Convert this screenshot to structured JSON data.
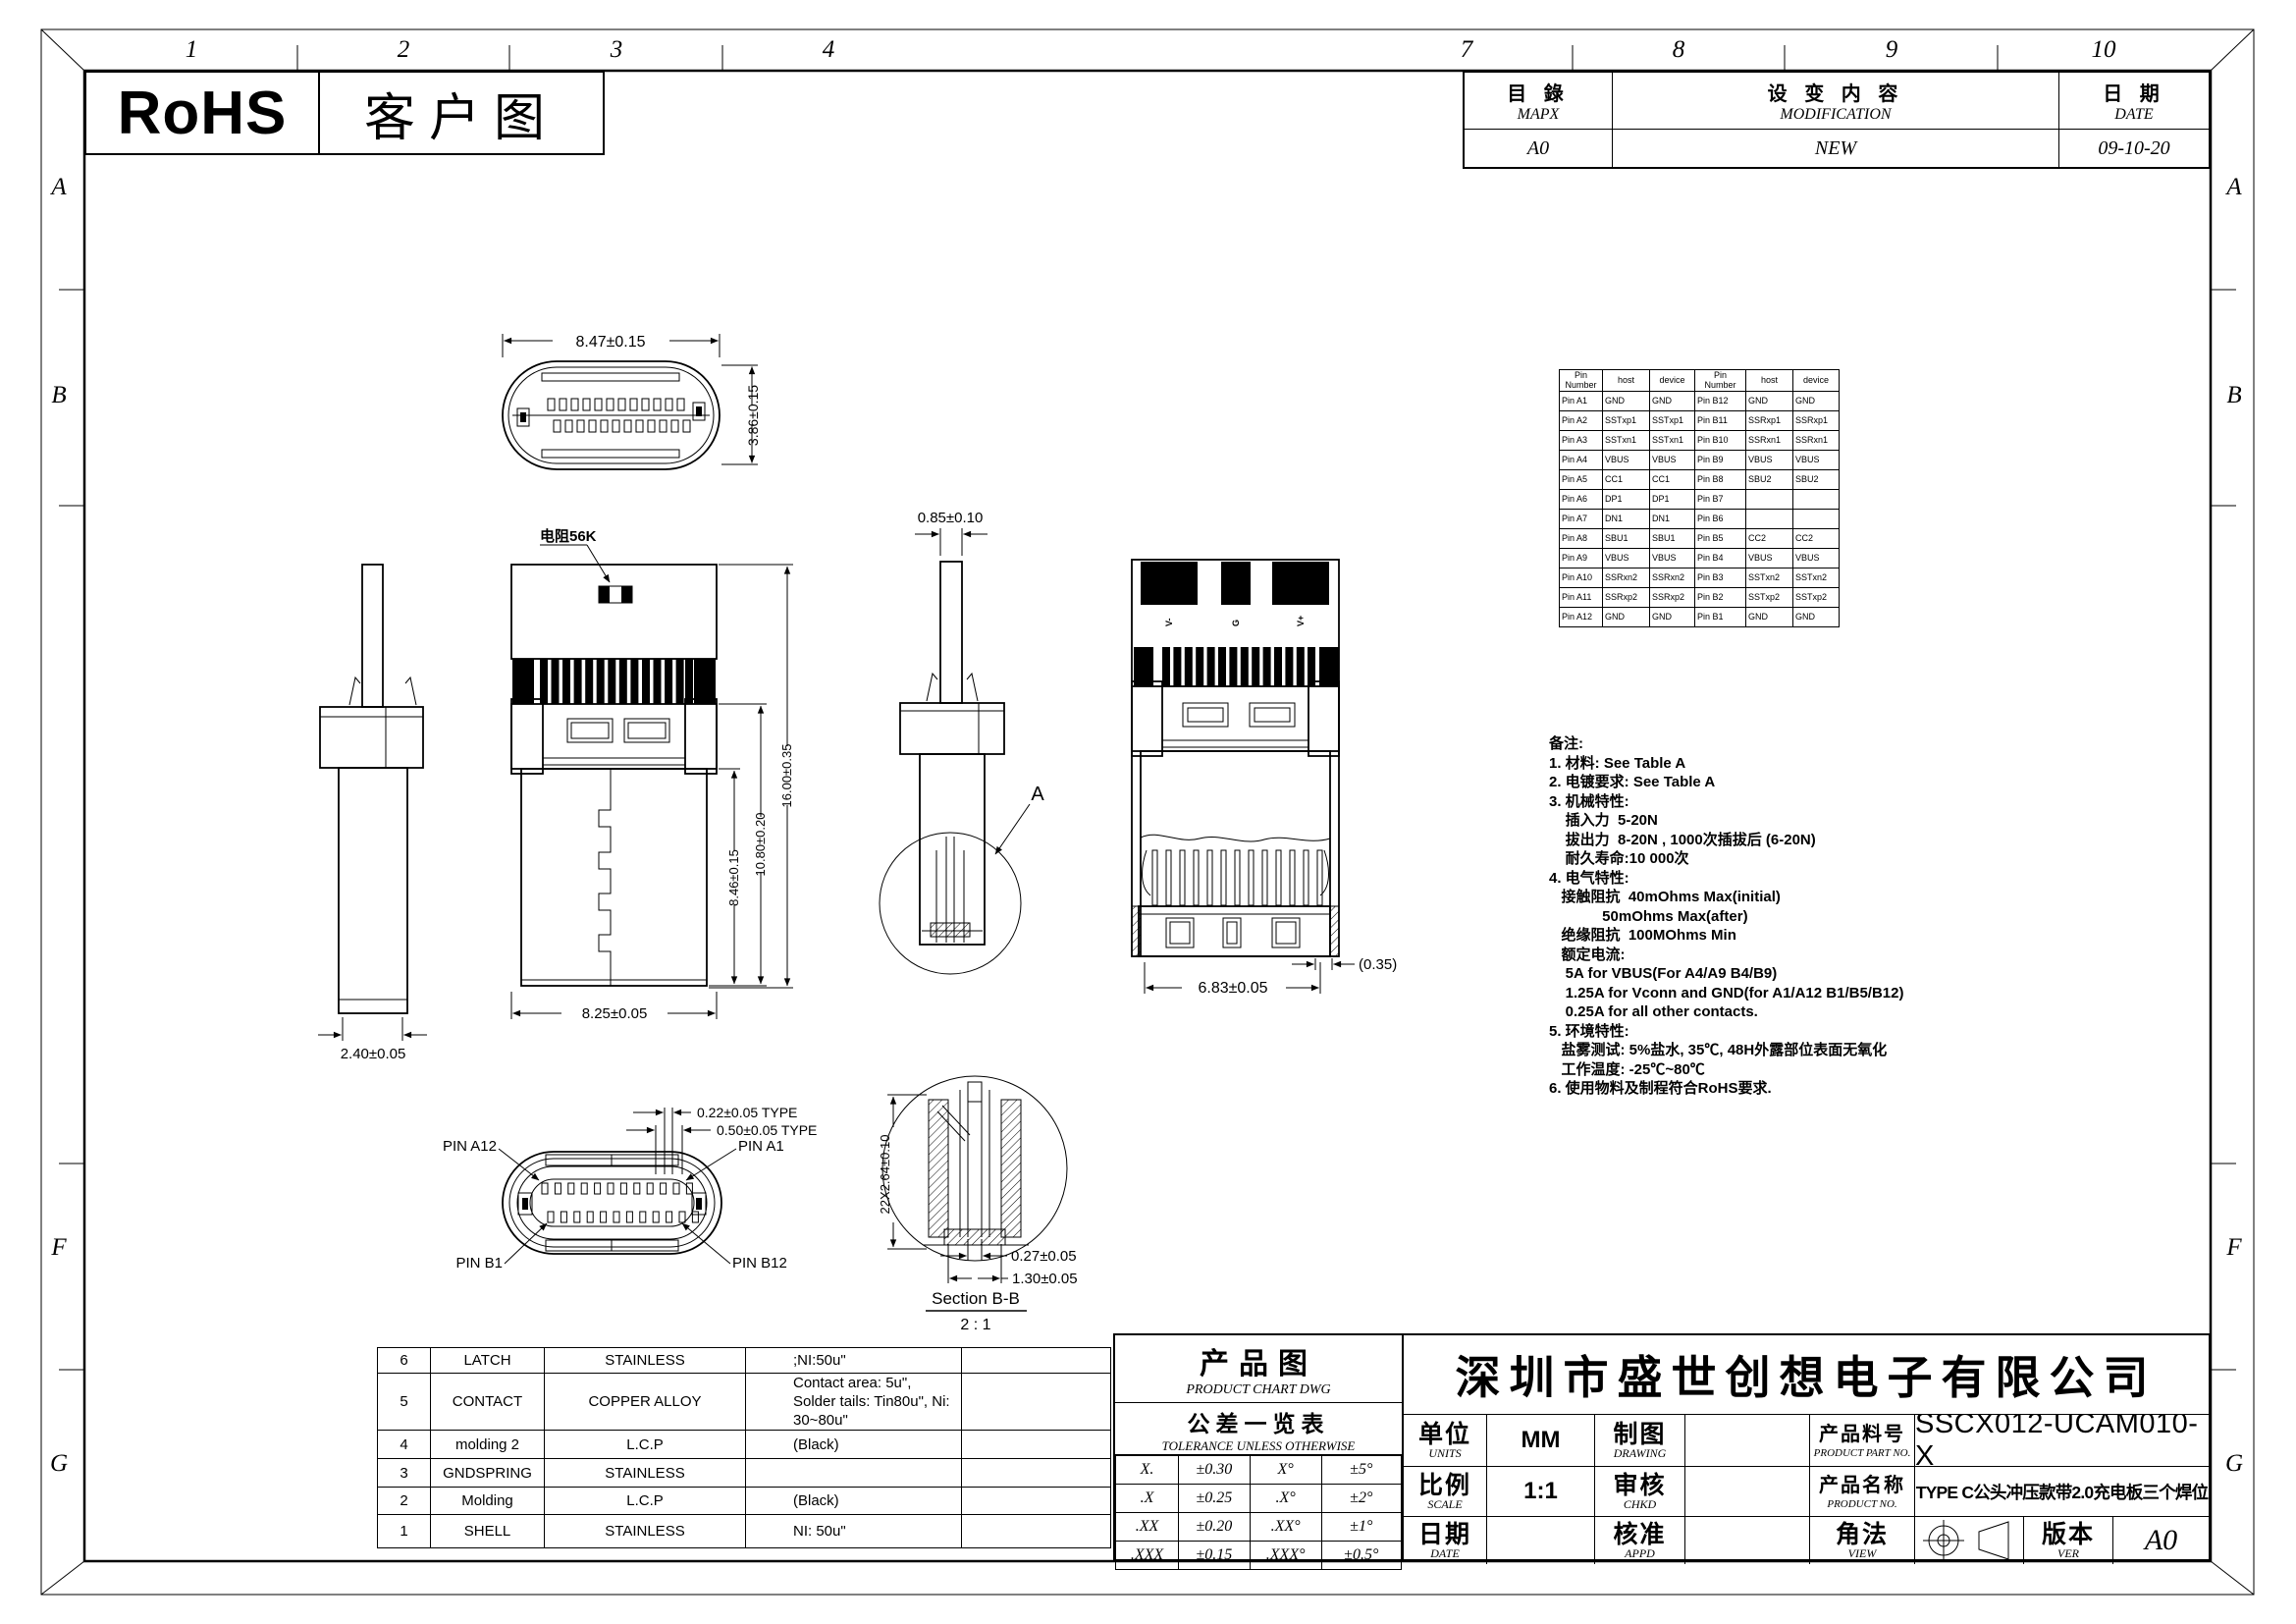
{
  "sheet": {
    "zone_numbers_top": [
      "1",
      "2",
      "3",
      "4",
      "7",
      "8",
      "9",
      "10"
    ],
    "zone_letters": [
      "A",
      "B",
      "F",
      "G"
    ]
  },
  "header": {
    "rohs": "RoHS",
    "customer_drawing": "客户图"
  },
  "revision_table": {
    "col1_cn": "目 錄",
    "col1_en": "MAPX",
    "col2_cn": "设 变 内 容",
    "col2_en": "MODIFICATION",
    "col3_cn": "日 期",
    "col3_en": "DATE",
    "row": {
      "mapx": "A0",
      "modification": "NEW",
      "date": "09-10-20"
    }
  },
  "pin_table": {
    "headers": [
      "Pin Number",
      "host",
      "device",
      "Pin Number",
      "host",
      "device"
    ],
    "rows": [
      [
        "Pin A1",
        "GND",
        "GND",
        "Pin B12",
        "GND",
        "GND"
      ],
      [
        "Pin A2",
        "SSTxp1",
        "SSTxp1",
        "Pin B11",
        "SSRxp1",
        "SSRxp1"
      ],
      [
        "Pin A3",
        "SSTxn1",
        "SSTxn1",
        "Pin B10",
        "SSRxn1",
        "SSRxn1"
      ],
      [
        "Pin A4",
        "VBUS",
        "VBUS",
        "Pin B9",
        "VBUS",
        "VBUS"
      ],
      [
        "Pin A5",
        "CC1",
        "CC1",
        "Pin B8",
        "SBU2",
        "SBU2"
      ],
      [
        "Pin A6",
        "DP1",
        "DP1",
        "Pin B7",
        "",
        ""
      ],
      [
        "Pin A7",
        "DN1",
        "DN1",
        "Pin B6",
        "",
        ""
      ],
      [
        "Pin A8",
        "SBU1",
        "SBU1",
        "Pin B5",
        "CC2",
        "CC2"
      ],
      [
        "Pin A9",
        "VBUS",
        "VBUS",
        "Pin B4",
        "VBUS",
        "VBUS"
      ],
      [
        "Pin A10",
        "SSRxn2",
        "SSRxn2",
        "Pin B3",
        "SSTxn2",
        "SSTxn2"
      ],
      [
        "Pin A11",
        "SSRxp2",
        "SSRxp2",
        "Pin B2",
        "SSTxp2",
        "SSTxp2"
      ],
      [
        "Pin A12",
        "GND",
        "GND",
        "Pin B1",
        "GND",
        "GND"
      ]
    ]
  },
  "notes": {
    "lines": [
      "备注:",
      "1. 材料: See Table A",
      "2. 电镀要求: See Table A",
      "3. 机械特性:",
      "    插入力  5-20N",
      "    拔出力  8-20N , 1000次插拔后 (6-20N)",
      "    耐久寿命:10 000次",
      "4. 电气特性:",
      "   接触阻抗  40mOhms Max(initial)",
      "             50mOhms Max(after)",
      "   绝缘阻抗  100MOhms Min",
      "   额定电流:",
      "    5A for VBUS(For A4/A9 B4/B9)",
      "    1.25A for Vconn and GND(for A1/A12 B1/B5/B12)",
      "    0.25A for all other contacts.",
      "5. 环境特性:",
      "   盐雾测试: 5%盐水, 35℃, 48H外露部位表面无氧化",
      "   工作温度: -25℃~80℃",
      "6. 使用物料及制程符合RoHS要求."
    ]
  },
  "views": {
    "top": {
      "w": "8.47±0.15",
      "h": "3.86±0.15"
    },
    "side1": {
      "w": "2.40±0.05"
    },
    "front": {
      "res": "电阻56K",
      "h1": "8.46±0.15",
      "h2": "10.80±0.20",
      "h3": "16.00±0.35",
      "w": "8.25±0.05"
    },
    "side2": {
      "tail": "0.85±0.10",
      "detail": "A"
    },
    "back": {
      "w": "6.83±0.05",
      "inset": "(0.35)",
      "pads": [
        "V-",
        "G",
        "V+"
      ]
    },
    "face": {
      "p1": "PIN A12",
      "p2": "PIN A1",
      "p3": "PIN B1",
      "p4": "PIN B12",
      "d1": "0.22±0.05 TYPE",
      "d2": "0.50±0.05 TYPE"
    },
    "section": {
      "v": "22X2.64±0.10",
      "d1": "0.27±0.05",
      "d2": "1.30±0.05",
      "title": "Section B-B",
      "scale": "2 : 1"
    }
  },
  "bom_table": {
    "rows": [
      [
        "6",
        "LATCH",
        "STAINLESS",
        ";NI:50u\"",
        ""
      ],
      [
        "5",
        "CONTACT",
        "COPPER ALLOY",
        "Contact area: 5u\",\nSolder tails: Tin80u\",  Ni: 30~80u\"",
        ""
      ],
      [
        "4",
        "molding 2",
        "L.C.P",
        "(Black)",
        ""
      ],
      [
        "3",
        "GNDSPRING",
        "STAINLESS",
        "",
        ""
      ],
      [
        "2",
        "Molding",
        "L.C.P",
        "(Black)",
        ""
      ],
      [
        "1",
        "SHELL",
        "STAINLESS",
        "NI: 50u\"",
        ""
      ]
    ]
  },
  "product_chart": {
    "title_cn": "产品图",
    "title_en": "PRODUCT CHART DWG",
    "tol_cn": "公差一览表",
    "tol_en": "TOLERANCE UNLESS OTHERWISE",
    "rows": [
      [
        "X.",
        "±0.30",
        "X°",
        "±5°"
      ],
      [
        ".X",
        "±0.25",
        ".X°",
        "±2°"
      ],
      [
        ".XX",
        "±0.20",
        ".XX°",
        "±1°"
      ],
      [
        ".XXX",
        "±0.15",
        ".XXX°",
        "±0.5°"
      ]
    ]
  },
  "title_block": {
    "company": "深圳市盛世创想电子有限公司",
    "units_cn": "单位",
    "units_en": "UNITS",
    "units_value": "MM",
    "drawing_cn": "制图",
    "drawing_en": "DRAWING",
    "part_no_cn": "产品料号",
    "part_no_en": "PRODUCT PART NO.",
    "part_no_value": "SSCX012-UCAM010-X",
    "scale_cn": "比例",
    "scale_en": "SCALE",
    "scale_value": "1:1",
    "chkd_cn": "审核",
    "chkd_en": "CHKD",
    "product_name_cn": "产品名称",
    "product_name_en": "PRODUCT NO.",
    "product_name_value": "TYPE C公头冲压款带2.0充电板三个焊位",
    "date_cn": "日期",
    "date_en": "DATE",
    "appd_cn": "核准",
    "appd_en": "APPD",
    "view_cn": "角法",
    "view_en": "VIEW",
    "ver_cn": "版本",
    "ver_en": "VER",
    "ver_value": "A0"
  }
}
